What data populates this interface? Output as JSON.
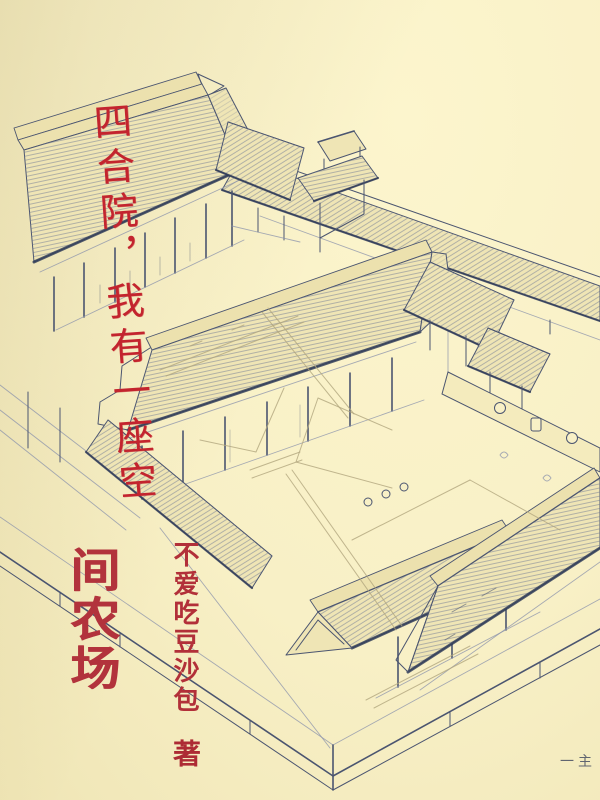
{
  "cover": {
    "title": {
      "script_text": "四合院，我有一座空",
      "bold_text": "间农场"
    },
    "author": {
      "name": "不爱吃豆沙包",
      "suffix": "著"
    },
    "corner_mark": "一主",
    "illustration_alt": "手绘四合院建筑群鸟瞰铅笔线稿",
    "colors": {
      "paper": "#f8f0c6",
      "sketch_ink": "#4b5570",
      "script_red": "#c3242e",
      "bold_red": "#b2333c",
      "author_red": "#b23039"
    }
  }
}
